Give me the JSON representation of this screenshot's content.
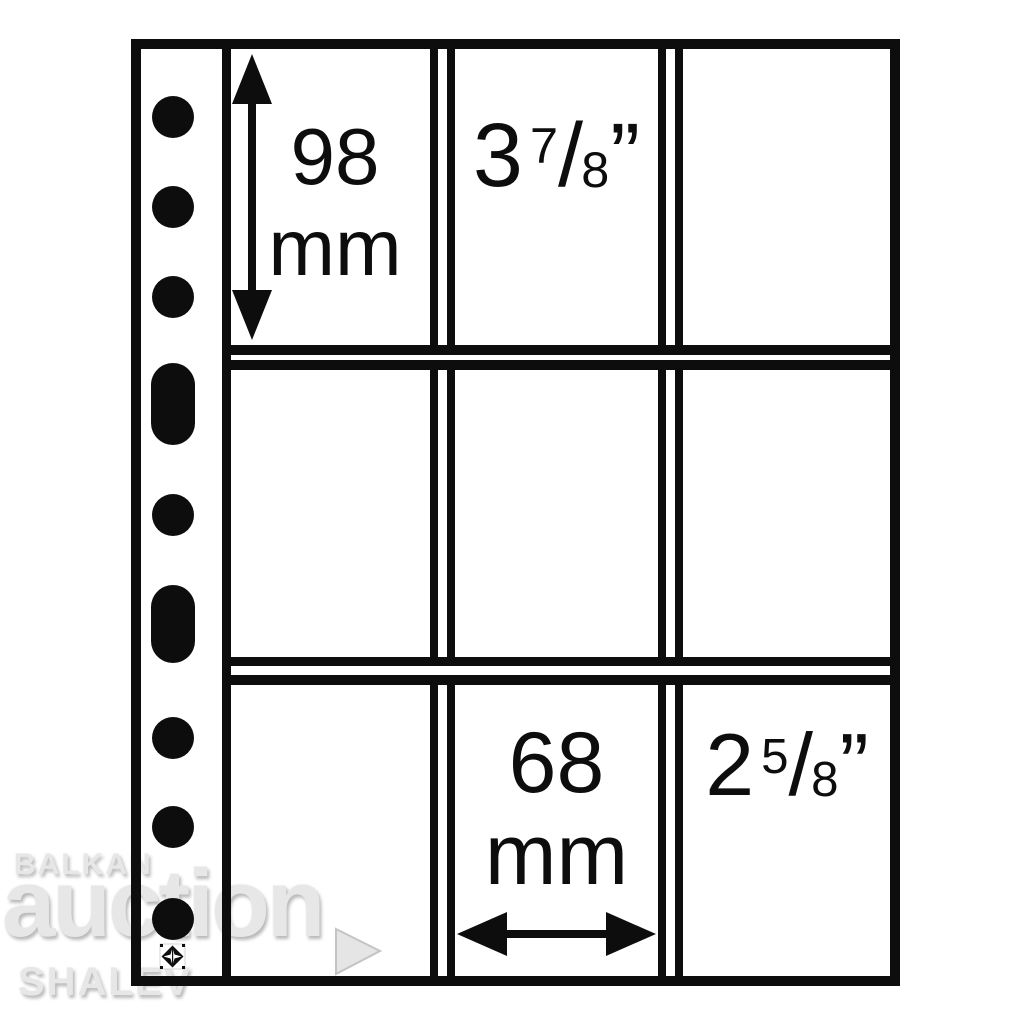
{
  "colors": {
    "ink": "#0d0d0d",
    "paper": "#ffffff",
    "watermark_fill": "#e7e7e7",
    "watermark_shadow": "#b9b9b9"
  },
  "sheet": {
    "top_left_cell": {
      "height_value": "98",
      "height_unit": "mm"
    },
    "top_middle_cell": {
      "inches_whole": "3",
      "inches_numerator": "7",
      "inches_slash": "/",
      "inches_denominator": "8",
      "inches_mark": "”"
    },
    "bottom_middle_cell": {
      "width_value": "68",
      "width_unit": "mm"
    },
    "bottom_right_cell": {
      "inches_whole": "2",
      "inches_numerator": "5",
      "inches_slash": "/",
      "inches_denominator": "8",
      "inches_mark": "”"
    }
  },
  "watermark": {
    "line1": "BALKAN",
    "line2": "auction",
    "line3": "SHALEV"
  }
}
